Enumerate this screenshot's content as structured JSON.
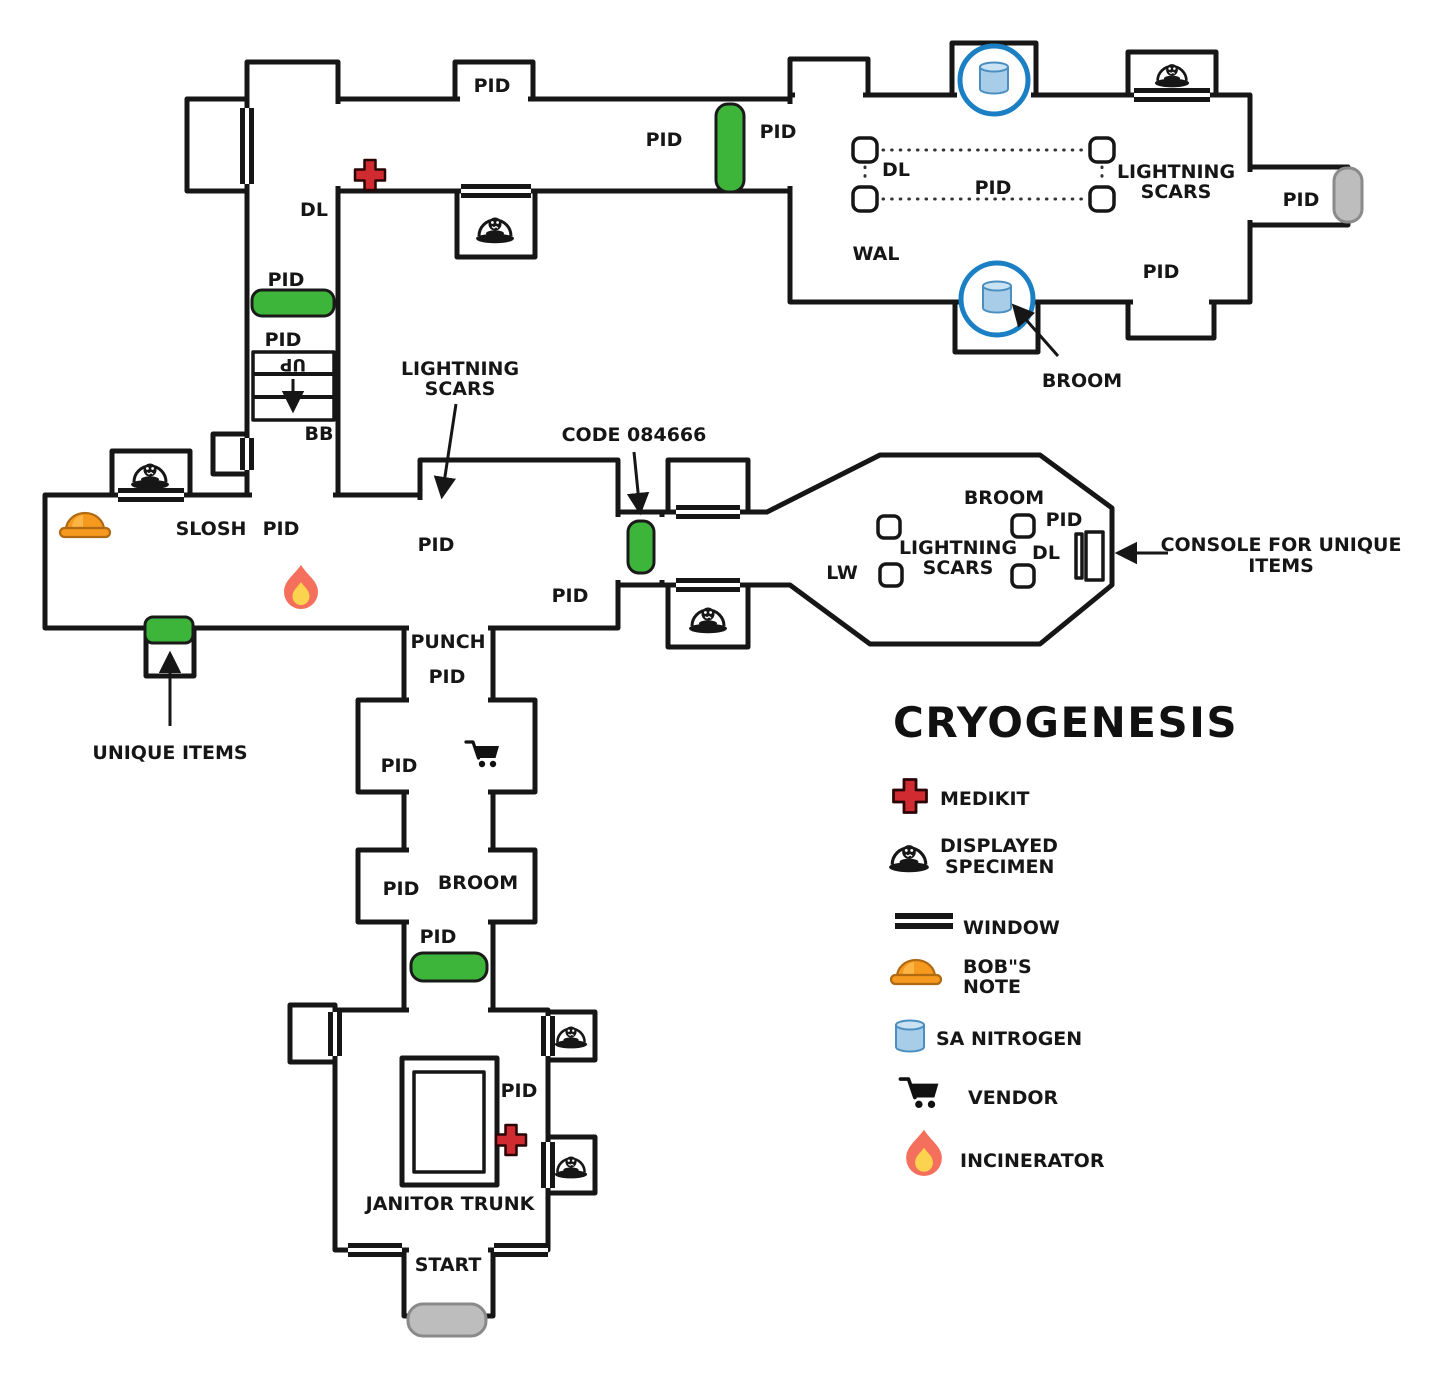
{
  "colors": {
    "wall": "#161616",
    "door_green": "#3db53a",
    "door_gray": "#bdbdbd",
    "door_gray_stroke": "#8a8a8a",
    "medikit_red": "#cf2b31",
    "nitrogen_fill": "#a7cde9",
    "nitrogen_top": "#c9e2f4",
    "nitrogen_stroke": "#4a8fc0",
    "circle_blue": "#1b7fc4",
    "flame_outer": "#f4705c",
    "flame_inner": "#fcd34f",
    "helmet_orange": "#f5991f",
    "helmet_stroke": "#b06a12",
    "ink": "#161616"
  },
  "map": {
    "labels": {
      "pid_top_bump": "PID",
      "pid_corr_left": "PID",
      "pid_corr_right": "PID",
      "dl_tall": "DL",
      "pid_above_door": "PID",
      "pid_below_door": "PID",
      "stairs_up": "UP",
      "bb": "BB",
      "dl_room": "DL",
      "pid_room": "PID",
      "wal": "WAL",
      "lightning1a": "LIGHTNING",
      "lightning1b": "SCARS",
      "pid_right_corr": "PID",
      "pid_room_bottom": "PID",
      "broom_top": "BROOM",
      "slosh": "SLOSH",
      "pid_left_room": "PID",
      "pid_mid1": "PID",
      "pid_mid2": "PID",
      "lightning2a": "LIGHTNING",
      "lightning2b": "SCARS",
      "code": "CODE 084666",
      "broom_oct": "BROOM",
      "pid_oct": "PID",
      "lightning3a": "LIGHTNING",
      "lightning3b": "SCARS",
      "dl_oct": "DL",
      "lw": "LW",
      "console1": "CONSOLE FOR UNIQUE",
      "console2": "ITEMS",
      "unique_items": "UNIQUE ITEMS",
      "punch": "PUNCH",
      "pid_punch": "PID",
      "pid_vendor": "PID",
      "pid_broom_room": "PID",
      "broom_room": "BROOM",
      "pid_before_door": "PID",
      "pid_janitor": "PID",
      "janitor_trunk": "JANITOR TRUNK",
      "start": "START"
    }
  },
  "legend": {
    "title": "CRYOGENESIS",
    "items": [
      {
        "icon": "medikit-icon",
        "lines": [
          "MEDIKIT"
        ]
      },
      {
        "icon": "displayed-specimen-icon",
        "lines": [
          "DISPLAYED",
          "SPECIMEN"
        ]
      },
      {
        "icon": "window-icon",
        "lines": [
          "WINDOW"
        ]
      },
      {
        "icon": "bobs-note-icon",
        "lines": [
          "BOB\"S",
          "NOTE"
        ]
      },
      {
        "icon": "sa-nitrogen-icon",
        "lines": [
          "SA NITROGEN"
        ]
      },
      {
        "icon": "vendor-icon",
        "lines": [
          "VENDOR"
        ]
      },
      {
        "icon": "incinerator-icon",
        "lines": [
          "INCINERATOR"
        ]
      }
    ]
  }
}
